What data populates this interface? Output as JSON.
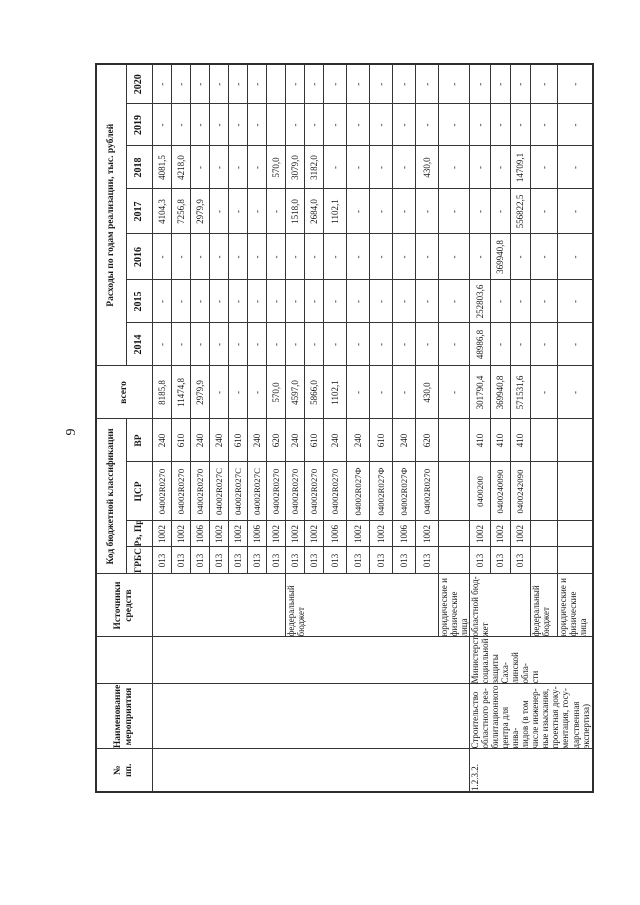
{
  "page": {
    "number": "9"
  },
  "table": {
    "header": {
      "no": "№\nпп.",
      "name": "Наименование\nмероприятия",
      "executor": "",
      "sources": "Источники\nсредств",
      "budget_class": "Код бюджетной классификации",
      "grbs": "ГРБС",
      "rz_pr": "Рз, Пр",
      "csr": "ЦСР",
      "vr": "ВР",
      "total": "всего",
      "expenses": "Расходы по годам реализации, тыс. рублей",
      "years": [
        "2014",
        "2015",
        "2016",
        "2017",
        "2018",
        "2019",
        "2020"
      ]
    },
    "blocks": [
      {
        "no": "",
        "name": "",
        "executor": "",
        "groups": [
          {
            "source": "",
            "rows": [
              {
                "grbs": "013",
                "rz": "1002",
                "csr": "04002R0270",
                "vr": "240",
                "total": "8185,8",
                "years": [
                  "-",
                  "-",
                  "-",
                  "4104,3",
                  "4081,5",
                  "-",
                  "-"
                ]
              },
              {
                "grbs": "013",
                "rz": "1002",
                "csr": "04002R0270",
                "vr": "610",
                "total": "11474,8",
                "years": [
                  "-",
                  "-",
                  "-",
                  "7256,8",
                  "4218,0",
                  "-",
                  "-"
                ]
              },
              {
                "grbs": "013",
                "rz": "1006",
                "csr": "04002R0270",
                "vr": "240",
                "total": "2979,9",
                "years": [
                  "-",
                  "-",
                  "-",
                  "2979,9",
                  "-",
                  "-",
                  "-"
                ]
              },
              {
                "grbs": "013",
                "rz": "1002",
                "csr": "04002R027С",
                "vr": "240",
                "total": "-",
                "years": [
                  "-",
                  "-",
                  "-",
                  "-",
                  "-",
                  "-",
                  "-"
                ]
              },
              {
                "grbs": "013",
                "rz": "1002",
                "csr": "04002R027С",
                "vr": "610",
                "total": "-",
                "years": [
                  "-",
                  "-",
                  "-",
                  "-",
                  "-",
                  "-",
                  "-"
                ]
              },
              {
                "grbs": "013",
                "rz": "1006",
                "csr": "04002R027С",
                "vr": "240",
                "total": "-",
                "years": [
                  "-",
                  "-",
                  "-",
                  "-",
                  "-",
                  "-",
                  "-"
                ]
              },
              {
                "grbs": "013",
                "rz": "1002",
                "csr": "04002R0270",
                "vr": "620",
                "total": "570,0",
                "years": [
                  "-",
                  "-",
                  "-",
                  "-",
                  "570,0",
                  "",
                  ""
                ]
              }
            ]
          },
          {
            "source": "федеральный\nбюджет",
            "rows": [
              {
                "grbs": "013",
                "rz": "1002",
                "csr": "04002R0270",
                "vr": "240",
                "total": "4597,0",
                "years": [
                  "-",
                  "-",
                  "-",
                  "1518,0",
                  "3079,0",
                  "-",
                  "-"
                ]
              },
              {
                "grbs": "013",
                "rz": "1002",
                "csr": "04002R0270",
                "vr": "610",
                "total": "5866,0",
                "years": [
                  "-",
                  "-",
                  "-",
                  "2684,0",
                  "3182,0",
                  "-",
                  "-"
                ]
              },
              {
                "grbs": "013",
                "rz": "1006",
                "csr": "04002R0270",
                "vr": "240",
                "total": "1102,1",
                "years": [
                  "-",
                  "-",
                  "-",
                  "1102,1",
                  "-",
                  "-",
                  "-"
                ]
              },
              {
                "grbs": "013",
                "rz": "1002",
                "csr": "04002R027Ф",
                "vr": "240",
                "total": "-",
                "years": [
                  "-",
                  "-",
                  "-",
                  "-",
                  "-",
                  "-",
                  "-"
                ]
              },
              {
                "grbs": "013",
                "rz": "1002",
                "csr": "04002R027Ф",
                "vr": "610",
                "total": "-",
                "years": [
                  "-",
                  "-",
                  "-",
                  "-",
                  "-",
                  "-",
                  "-"
                ]
              },
              {
                "grbs": "013",
                "rz": "1006",
                "csr": "04002R027Ф",
                "vr": "240",
                "total": "-",
                "years": [
                  "-",
                  "-",
                  "-",
                  "-",
                  "-",
                  "-",
                  "-"
                ]
              },
              {
                "grbs": "013",
                "rz": "1002",
                "csr": "04002R0270",
                "vr": "620",
                "total": "430,0",
                "years": [
                  "-",
                  "-",
                  "-",
                  "-",
                  "430,0",
                  "-",
                  "-"
                ]
              }
            ]
          },
          {
            "source": "юридические и\nфизические лица",
            "rows": [
              {
                "grbs": "",
                "rz": "",
                "csr": "",
                "vr": "",
                "total": "-",
                "years": [
                  "-",
                  "-",
                  "-",
                  "-",
                  "-",
                  "-",
                  "-"
                ]
              }
            ]
          }
        ]
      },
      {
        "no": "1.2.3.2.",
        "name": "Строительство\nобластного реа-\nбилитационного\nцентра для инва-\nлидов (в том\nчисле инженер-\nные изыскания,\nпроектная доку-\nментация, госу-\nдарственная\nэкспертиза)",
        "executor": "Министерство\nсоциальной\nзащиты Саха-\nлинской обла-\nсти",
        "groups": [
          {
            "source": "областной бюд-\nжет",
            "rows": [
              {
                "grbs": "013",
                "rz": "1002",
                "csr": "0400200",
                "vr": "410",
                "total": "301790,4",
                "years": [
                  "48986,8",
                  "252803,6",
                  "-",
                  "-",
                  "-",
                  "-",
                  "-"
                ]
              },
              {
                "grbs": "013",
                "rz": "1002",
                "csr": "0400240090",
                "vr": "410",
                "total": "369940,8",
                "years": [
                  "-",
                  "-",
                  "369940,8",
                  "-",
                  "-",
                  "-",
                  "-"
                ]
              },
              {
                "grbs": "013",
                "rz": "1002",
                "csr": "0400242090",
                "vr": "410",
                "total": "571531,6",
                "years": [
                  "-",
                  "-",
                  "-",
                  "556822,5",
                  "14709,1",
                  "-",
                  "-"
                ]
              }
            ]
          },
          {
            "source": "федеральный\nбюджет",
            "rows": [
              {
                "grbs": "",
                "rz": "",
                "csr": "",
                "vr": "",
                "total": "-",
                "years": [
                  "-",
                  "-",
                  "-",
                  "-",
                  "-",
                  "-",
                  "-"
                ]
              }
            ]
          },
          {
            "source": "юридические и\nфизические лица",
            "rows": [
              {
                "grbs": "",
                "rz": "",
                "csr": "",
                "vr": "",
                "total": "-",
                "years": [
                  "-",
                  "-",
                  "-",
                  "-",
                  "-",
                  "-",
                  "-"
                ]
              }
            ]
          }
        ]
      }
    ]
  }
}
